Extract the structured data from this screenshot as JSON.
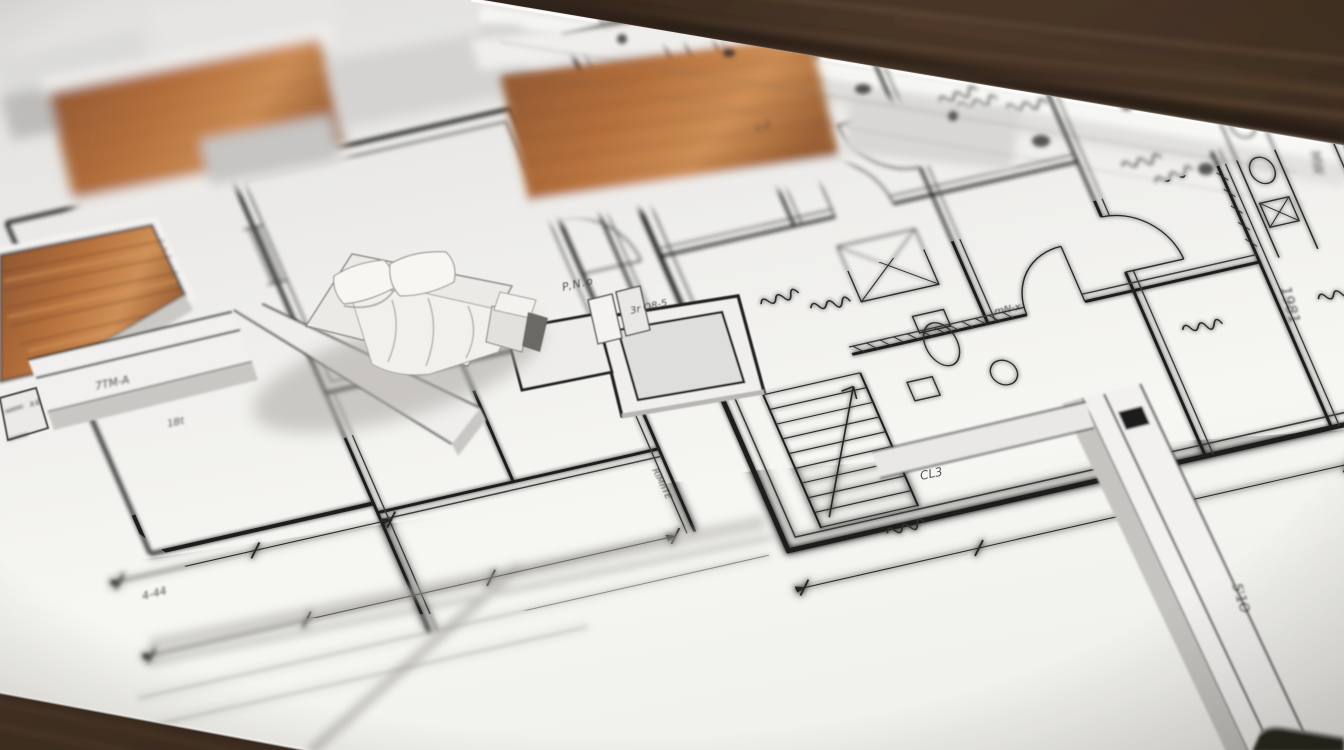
{
  "palette": {
    "table_wood_dark": "#241a12",
    "table_wood_mid": "#4a3628",
    "table_wood_light": "#7a5f49",
    "paper": "#efeeec",
    "paper_bright": "#f7f7f5",
    "ink": "#1d1d1b",
    "ink_soft": "#4a4846",
    "floor_wood": "#a96a38",
    "floor_wood_light": "#cf8f56",
    "wall_white": "#f2f1ef",
    "wall_shadow_gray": "#c9c7c3",
    "bed_linen": "#f2f0ec",
    "cast_shadow": "#a9a7a1"
  },
  "annotations": {
    "a1": "P,N.o",
    "a2": "3r O8-5",
    "a3": "CL3",
    "a4": "1981",
    "a5": "MW",
    "a6": "5'1O",
    "a7": "7TM-A",
    "a8": "1Bt",
    "a9": "4-44",
    "a10": "RlMnTE",
    "a11": "x4",
    "a12": "mN-x",
    "a13": "c-2"
  }
}
